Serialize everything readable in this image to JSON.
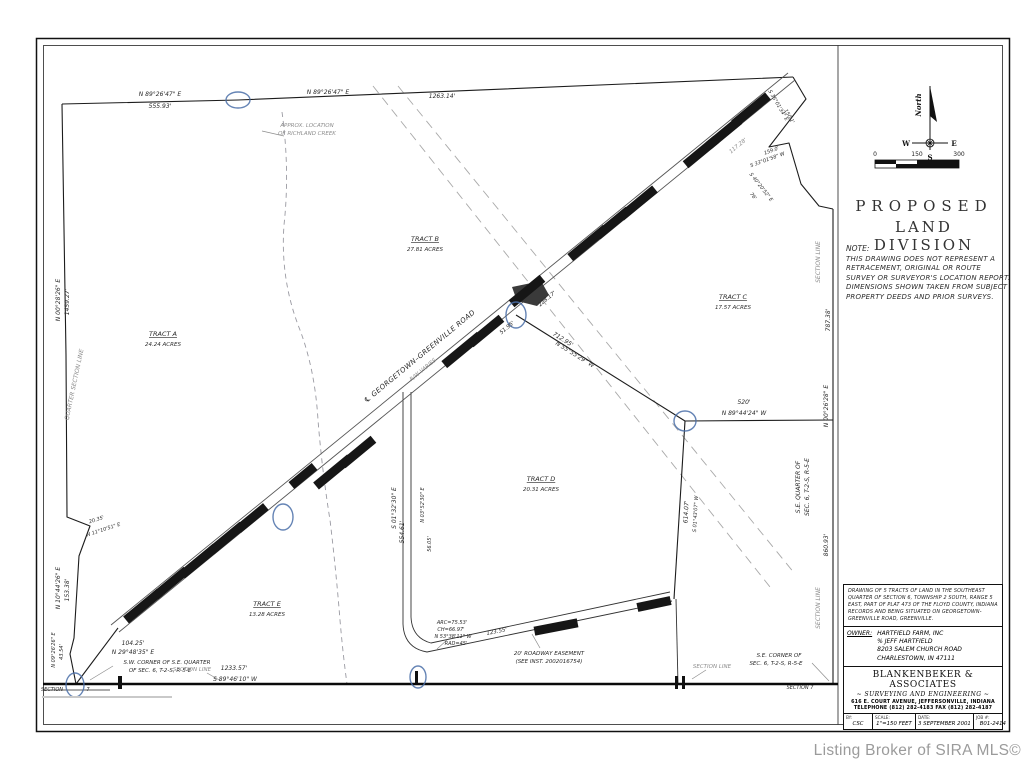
{
  "watermark": "Listing Broker of SIRA MLS©",
  "compass": {
    "north": "North",
    "w": "W",
    "e": "E",
    "s": "S"
  },
  "scalebar": {
    "t0": "0",
    "t1": "150",
    "t2": "300"
  },
  "title": {
    "line1": "PROPOSED",
    "line2": "LAND  DIVISION"
  },
  "note": {
    "label": "NOTE:",
    "body": "THIS DRAWING DOES NOT REPRESENT A RETRACEMENT, ORIGINAL OR ROUTE SURVEY OR SURVEYOR'S LOCATION REPORT.  DIMENSIONS SHOWN TAKEN FROM SUBJECT PROPERTY DEEDS AND PRIOR SURVEYS."
  },
  "title_block": {
    "description": "DRAWING OF 5 TRACTS OF LAND IN THE SOUTHEAST QUARTER OF SECTION 6, TOWNSHIP 2 SOUTH, RANGE 5 EAST, PART OF PLAT 473 OF THE FLOYD COUNTY, INDIANA RECORDS AND BEING SITUATED ON GEORGETOWN-GREENVILLE ROAD, GREENVILLE.",
    "owner_label": "OWNER:",
    "owner_lines": [
      "HARTFIELD FARM, INC",
      "% JEFF HARTFIELD",
      "8203 SALEM CHURCH ROAD",
      "CHARLESTOWN, IN 47111"
    ],
    "firm": "BLANKENBEKER  &  ASSOCIATES",
    "firm_sub": "~ SURVEYING AND ENGINEERING ~",
    "firm_addr": "616 E. COURT AVENUE, JEFFERSONVILLE, INDIANA",
    "firm_phone": "TELEPHONE (812) 282-4183    FAX (812) 282-4187",
    "by_label": "BY:",
    "by": "CSC",
    "scale_label": "SCALE:",
    "scale": "1\"=150 FEET",
    "date_label": "DATE:",
    "date": "3 SEPTEMBER 2001",
    "job_label": "JOB #:",
    "job": "B01-2414"
  },
  "tracts": [
    {
      "name": "TRACT A",
      "acres": "24.24 ACRES",
      "x": 163,
      "y": 336
    },
    {
      "name": "TRACT B",
      "acres": "27.81 ACRES",
      "x": 425,
      "y": 241
    },
    {
      "name": "TRACT C",
      "acres": "17.57 ACRES",
      "x": 733,
      "y": 299
    },
    {
      "name": "TRACT D",
      "acres": "20.31 ACRES",
      "x": 541,
      "y": 481
    },
    {
      "name": "TRACT E",
      "acres": "13.28 ACRES",
      "x": 267,
      "y": 606
    }
  ],
  "drawing": {
    "labels": [
      {
        "x": 160,
        "y": 96,
        "t": "N 89°26'47\" E"
      },
      {
        "x": 160,
        "y": 108,
        "t": "555.93'"
      },
      {
        "x": 328,
        "y": 94,
        "t": "N 89°26'47\" E"
      },
      {
        "x": 442,
        "y": 98,
        "t": "1263.14'"
      },
      {
        "x": 307,
        "y": 127,
        "t": "APPROX. LOCATION",
        "c": "g",
        "s": 5.5
      },
      {
        "x": 307,
        "y": 135,
        "t": "OF RICHLAND CREEK",
        "c": "g",
        "s": 5.5
      },
      {
        "x": 421,
        "y": 358,
        "r": -39.5,
        "t": "℄ GEORGETOWN–GREENVILLE ROAD",
        "c": "big"
      },
      {
        "x": 424,
        "y": 371,
        "r": -39.5,
        "t": "R/W VARIES",
        "c": "g",
        "s": 5.5
      },
      {
        "x": 508,
        "y": 329,
        "r": -39.5,
        "t": "51.95'",
        "s": 5.5
      },
      {
        "x": 548,
        "y": 300,
        "r": -39.5,
        "t": "228.17'",
        "s": 5.5
      },
      {
        "x": 739,
        "y": 147,
        "r": -39.5,
        "t": "117.28'",
        "c": "g",
        "s": 5.5
      },
      {
        "x": 562,
        "y": 341,
        "r": 32,
        "t": "712.95'"
      },
      {
        "x": 574,
        "y": 356,
        "r": 32,
        "t": "N 55°55'29\" W"
      },
      {
        "x": 744,
        "y": 404,
        "t": "520'"
      },
      {
        "x": 744,
        "y": 415,
        "t": "N 89°44'24\" W"
      },
      {
        "x": 820,
        "y": 262,
        "r": -90,
        "t": "SECTION LINE",
        "c": "g"
      },
      {
        "x": 830,
        "y": 320,
        "r": -90,
        "t": "787.38'"
      },
      {
        "x": 828,
        "y": 406,
        "r": -90,
        "t": "N 00°26'28\" E"
      },
      {
        "x": 800,
        "y": 487,
        "r": -90,
        "t": "S.E. QUARTER OF"
      },
      {
        "x": 809,
        "y": 487,
        "r": -90,
        "t": "SEC. 6, T-2-S, R-5-E"
      },
      {
        "x": 828,
        "y": 545,
        "r": -90,
        "t": "860.93'"
      },
      {
        "x": 820,
        "y": 608,
        "r": -90,
        "t": "SECTION LINE",
        "c": "g"
      },
      {
        "x": 60,
        "y": 300,
        "r": -90,
        "t": "N 00°28'26\" E"
      },
      {
        "x": 69,
        "y": 302,
        "r": -90,
        "t": "1459.27'"
      },
      {
        "x": 76,
        "y": 385,
        "r": -78,
        "t": "QUARTER SECTION LINE",
        "c": "g"
      },
      {
        "x": 60,
        "y": 588,
        "r": -90,
        "t": "N 10°44'26\" E"
      },
      {
        "x": 69,
        "y": 590,
        "r": -90,
        "t": "153.38'"
      },
      {
        "x": 55,
        "y": 650,
        "r": -90,
        "t": "N 09°26'26\" E",
        "s": 5
      },
      {
        "x": 63,
        "y": 652,
        "r": -90,
        "t": "43.54'",
        "s": 5
      },
      {
        "x": 97,
        "y": 521,
        "r": -18,
        "t": "20.35'",
        "s": 5
      },
      {
        "x": 104,
        "y": 531,
        "r": -18,
        "t": "N 11°10'51\" E",
        "s": 5
      },
      {
        "x": 133,
        "y": 645,
        "t": "104.25'"
      },
      {
        "x": 133,
        "y": 654,
        "t": "N 29°48'35\" E"
      },
      {
        "x": 167,
        "y": 664,
        "t": "S.W. CORNER OF S.E. QUARTER",
        "s": 5.5
      },
      {
        "x": 160,
        "y": 672,
        "t": "OF SEC. 6, T-2-S, R-5-E",
        "s": 5.5
      },
      {
        "x": 52,
        "y": 691,
        "t": "SECTION",
        "s": 5
      },
      {
        "x": 88,
        "y": 691,
        "t": "7",
        "s": 5
      },
      {
        "x": 192,
        "y": 671,
        "t": "SECTION LINE",
        "c": "g",
        "s": 5.5
      },
      {
        "x": 234,
        "y": 670,
        "t": "1233.57'"
      },
      {
        "x": 235,
        "y": 681,
        "t": "S 89°46'10\" W"
      },
      {
        "x": 712,
        "y": 668,
        "t": "SECTION LINE",
        "c": "g",
        "s": 5.5
      },
      {
        "x": 779,
        "y": 657,
        "t": "S.E. CORNER OF",
        "s": 5.5
      },
      {
        "x": 776,
        "y": 665,
        "t": "SEC. 6, T-2-S, R-5-E",
        "s": 5.5
      },
      {
        "x": 800,
        "y": 689,
        "t": "SECTION 7",
        "s": 5
      },
      {
        "x": 396,
        "y": 508,
        "r": -90,
        "t": "S 01°32'30\" E"
      },
      {
        "x": 404,
        "y": 532,
        "r": -90,
        "t": "554.61'"
      },
      {
        "x": 424,
        "y": 505,
        "r": -90,
        "t": "N 03°52'30\" E",
        "s": 5
      },
      {
        "x": 431,
        "y": 544,
        "r": -90,
        "t": "56.05'",
        "s": 5
      },
      {
        "x": 452,
        "y": 624,
        "t": "ARC=75.53'",
        "s": 5
      },
      {
        "x": 451,
        "y": 631,
        "t": "CH=66.97'",
        "s": 5
      },
      {
        "x": 453,
        "y": 638,
        "t": "N 53°38'11\" W",
        "s": 5
      },
      {
        "x": 456,
        "y": 645,
        "t": "RAD=45'",
        "s": 5
      },
      {
        "x": 497,
        "y": 633,
        "r": -11,
        "t": "123.55'",
        "s": 5.5
      },
      {
        "x": 549,
        "y": 655,
        "t": "20' ROADWAY EASEMENT",
        "s": 5.5
      },
      {
        "x": 549,
        "y": 663,
        "t": "(SEE INST. 2002016754)",
        "s": 5.5
      },
      {
        "x": 688,
        "y": 512,
        "r": -87,
        "t": "614.07'"
      },
      {
        "x": 697,
        "y": 514,
        "r": -87,
        "t": "S 01°43'07\" W",
        "s": 5
      },
      {
        "x": 777,
        "y": 106,
        "r": 60,
        "t": "S 35°01'34\" E",
        "s": 5
      },
      {
        "x": 788,
        "y": 117,
        "r": 60,
        "t": "150.1'",
        "s": 5
      },
      {
        "x": 772,
        "y": 152,
        "r": -20,
        "t": "159.0'",
        "s": 5
      },
      {
        "x": 768,
        "y": 161,
        "r": -20,
        "t": "S 33°01'58\" W",
        "s": 5
      },
      {
        "x": 760,
        "y": 188,
        "r": 52,
        "t": "S 40°20'52\" E",
        "s": 5
      },
      {
        "x": 752,
        "y": 197,
        "r": 52,
        "t": "76'",
        "s": 5
      }
    ],
    "boxes": [
      {
        "x": 143,
        "y": 606,
        "r": -39.5,
        "w": 44
      },
      {
        "x": 171,
        "y": 583,
        "r": -39.5,
        "w": 40
      },
      {
        "x": 199,
        "y": 561,
        "r": -39.5,
        "w": 44
      },
      {
        "x": 227,
        "y": 538,
        "r": -39.5,
        "w": 40
      },
      {
        "x": 252,
        "y": 518,
        "r": -39.5,
        "w": 36
      },
      {
        "x": 303,
        "y": 476,
        "r": -39.5,
        "w": 30
      },
      {
        "x": 333,
        "y": 472,
        "r": -39.5,
        "w": 44
      },
      {
        "x": 358,
        "y": 452,
        "r": -39.5,
        "w": 40
      },
      {
        "x": 462,
        "y": 350,
        "r": -39.5,
        "w": 46
      },
      {
        "x": 486,
        "y": 331,
        "r": -39.5,
        "w": 40
      },
      {
        "x": 527,
        "y": 291,
        "r": -39.5,
        "w": 40
      },
      {
        "x": 588,
        "y": 243,
        "r": -39.5,
        "w": 46
      },
      {
        "x": 613,
        "y": 223,
        "r": -39.5,
        "w": 40
      },
      {
        "x": 638,
        "y": 203,
        "r": -39.5,
        "w": 44
      },
      {
        "x": 701,
        "y": 152,
        "r": -39.5,
        "w": 40
      },
      {
        "x": 724,
        "y": 133,
        "r": -39.5,
        "w": 40
      },
      {
        "x": 751,
        "y": 110,
        "r": -39.5,
        "w": 44
      },
      {
        "x": 556,
        "y": 627,
        "r": -11,
        "w": 44
      },
      {
        "x": 654,
        "y": 604,
        "r": -12,
        "w": 34
      }
    ],
    "ellipses": [
      {
        "x": 238,
        "y": 100,
        "rx": 12,
        "ry": 8
      },
      {
        "x": 516,
        "y": 315,
        "rx": 10,
        "ry": 13
      },
      {
        "x": 685,
        "y": 421,
        "rx": 11,
        "ry": 10
      },
      {
        "x": 283,
        "y": 517,
        "rx": 10,
        "ry": 13
      },
      {
        "x": 75,
        "y": 685,
        "rx": 9,
        "ry": 12
      },
      {
        "x": 418,
        "y": 677,
        "rx": 8,
        "ry": 11
      }
    ]
  }
}
